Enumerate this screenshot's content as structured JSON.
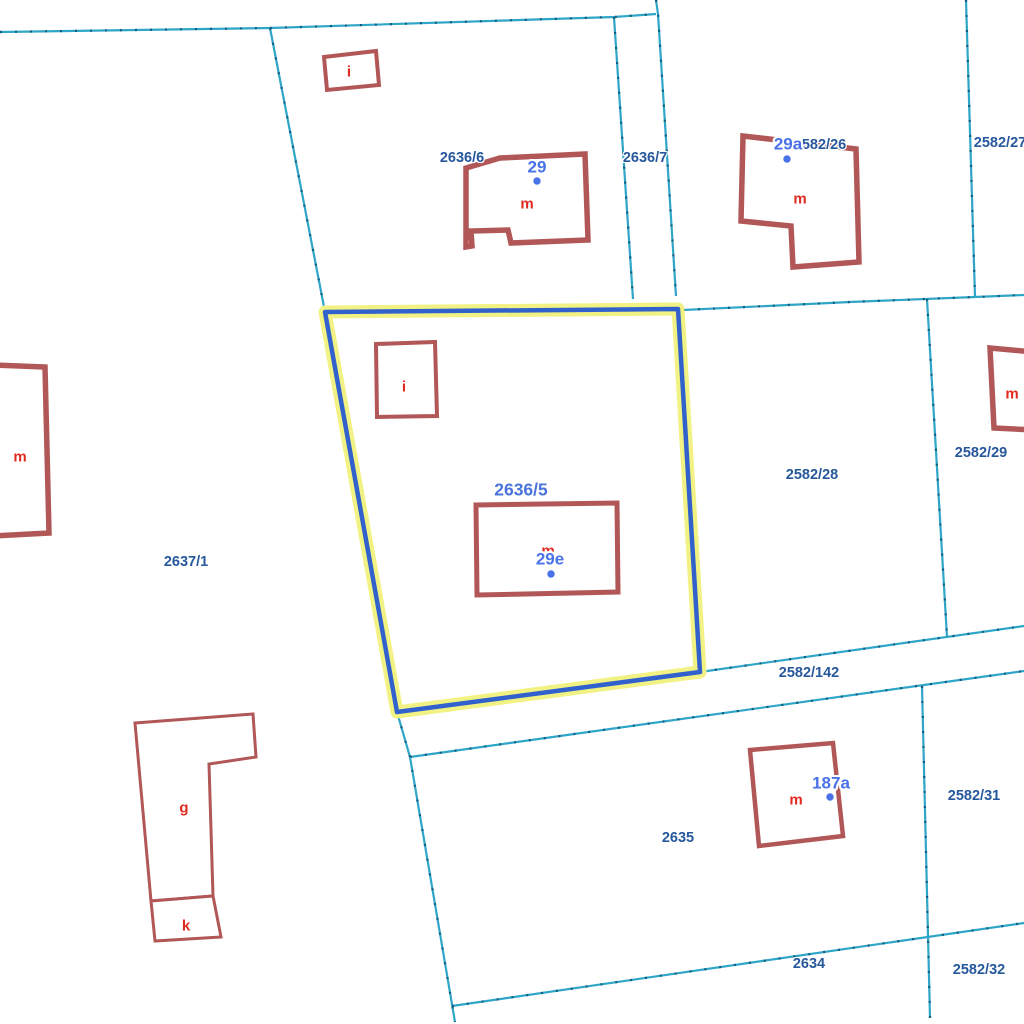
{
  "app": {
    "type": "cadastral-map-view",
    "background": "#ffffff"
  },
  "colors": {
    "parcel_line": "#2fa5c8",
    "parcel_line_tick": "#0f5d7a",
    "building_stroke": "#b25757",
    "building_fill": "#ffffff",
    "parcel_label": "#27589c",
    "house_number": "#4a72e8",
    "house_number_dot": "#4a72e8",
    "building_letter": "#e02a20",
    "selected_parcel_label": "#4a74da",
    "highlight_stroke": "#3161cd",
    "highlight_halo": "#f1f283"
  },
  "selected_parcel": {
    "id": "2636/5",
    "x": 521,
    "y": 490
  },
  "parcels": [
    {
      "id": "2636/6",
      "x": 462,
      "y": 158
    },
    {
      "id": "2636/7",
      "x": 645,
      "y": 158
    },
    {
      "id": "2582/26",
      "x": 820,
      "y": 145
    },
    {
      "id": "2582/27",
      "x": 1000,
      "y": 143
    },
    {
      "id": "2582/28",
      "x": 812,
      "y": 475
    },
    {
      "id": "2582/29",
      "x": 981,
      "y": 453
    },
    {
      "id": "2582/142",
      "x": 809,
      "y": 673
    },
    {
      "id": "2637/1",
      "x": 186,
      "y": 562
    },
    {
      "id": "2635",
      "x": 678,
      "y": 838
    },
    {
      "id": "2582/31",
      "x": 974,
      "y": 796
    },
    {
      "id": "2634",
      "x": 809,
      "y": 964
    },
    {
      "id": "2582/32",
      "x": 979,
      "y": 970
    }
  ],
  "house_numbers": [
    {
      "text": "29",
      "x": 537,
      "y": 167,
      "dot": {
        "cx": 537,
        "cy": 181
      }
    },
    {
      "text": "29a",
      "x": 788,
      "y": 144,
      "dot": {
        "cx": 787,
        "cy": 159
      }
    },
    {
      "text": "29e",
      "x": 550,
      "y": 559,
      "dot": {
        "cx": 551,
        "cy": 574
      }
    },
    {
      "text": "187a",
      "x": 831,
      "y": 783,
      "dot": {
        "cx": 830,
        "cy": 797
      }
    }
  ],
  "building_letters": [
    {
      "text": "i",
      "x": 349,
      "y": 72
    },
    {
      "text": "m",
      "x": 527,
      "y": 204
    },
    {
      "text": "m",
      "x": 800,
      "y": 199
    },
    {
      "text": "m",
      "x": 1012,
      "y": 394
    },
    {
      "text": "m",
      "x": 20,
      "y": 457
    },
    {
      "text": "i",
      "x": 404,
      "y": 387
    },
    {
      "text": "m",
      "x": 548,
      "y": 551
    },
    {
      "text": "g",
      "x": 184,
      "y": 808
    },
    {
      "text": "k",
      "x": 186,
      "y": 926
    },
    {
      "text": "m",
      "x": 796,
      "y": 800
    }
  ],
  "geometry": {
    "boundaries": [
      {
        "name": "boundary-north",
        "points": "0,32 270,28 614,17 656,14"
      },
      {
        "name": "boundary-northwest-diag",
        "points": "270,28 325,312"
      },
      {
        "name": "boundary-strip-west",
        "points": "614,17 633,299"
      },
      {
        "name": "boundary-strip-east",
        "points": "656,0 658,14 676,296"
      },
      {
        "name": "boundary-mid-east",
        "points": "683,310 850,302 975,297 1024,295"
      },
      {
        "name": "boundary-26-27",
        "points": "966,0 975,297"
      },
      {
        "name": "boundary-28-29",
        "points": "927,299 947,637"
      },
      {
        "name": "boundary-142-north",
        "points": "700,672 1024,626"
      },
      {
        "name": "boundary-142-south",
        "points": "410,757 1024,671"
      },
      {
        "name": "boundary-2635-west",
        "points": "397,712 410,757 455,1022"
      },
      {
        "name": "boundary-2634-north",
        "points": "452,1006 1024,923"
      },
      {
        "name": "boundary-2635-31",
        "points": "922,686 930,1018"
      }
    ],
    "highlighted_parcel": {
      "points": "325,312 678,309 700,672 397,712",
      "halo_width": 13,
      "stroke_width": 4.5
    },
    "buildings": [
      {
        "name": "building-i-north",
        "points": "324,57 376,51 379,85 327,90",
        "w": 4
      },
      {
        "name": "building-house-29",
        "points": "466,168 500,158 585,154 588,240 511,243 508,230 471,231 472,246 466,247",
        "w": 5.5
      },
      {
        "name": "building-house-29a",
        "points": "743,136 856,149 859,262 793,267 791,226 741,221",
        "w": 5.5
      },
      {
        "name": "building-m-east",
        "points": "990,348 1034,352 1034,430 994,428",
        "w": 5.5
      },
      {
        "name": "building-m-west",
        "points": "-8,365 45,367 49,533 -8,536",
        "w": 5.5
      },
      {
        "name": "building-i-selected",
        "points": "376,344 435,342 437,416 377,417",
        "w": 4
      },
      {
        "name": "building-house-29e",
        "points": "476,505 617,503 618,592 477,595",
        "w": 5
      },
      {
        "name": "building-house-187a",
        "points": "750,750 833,743 843,836 759,846",
        "w": 4.5
      },
      {
        "name": "building-g",
        "points": "135,723 253,714 256,757 209,764 213,896 151,901",
        "w": 3
      },
      {
        "name": "building-k",
        "points": "151,901 213,896 221,937 155,941",
        "w": 3
      }
    ],
    "dot_radius": 4.3
  }
}
